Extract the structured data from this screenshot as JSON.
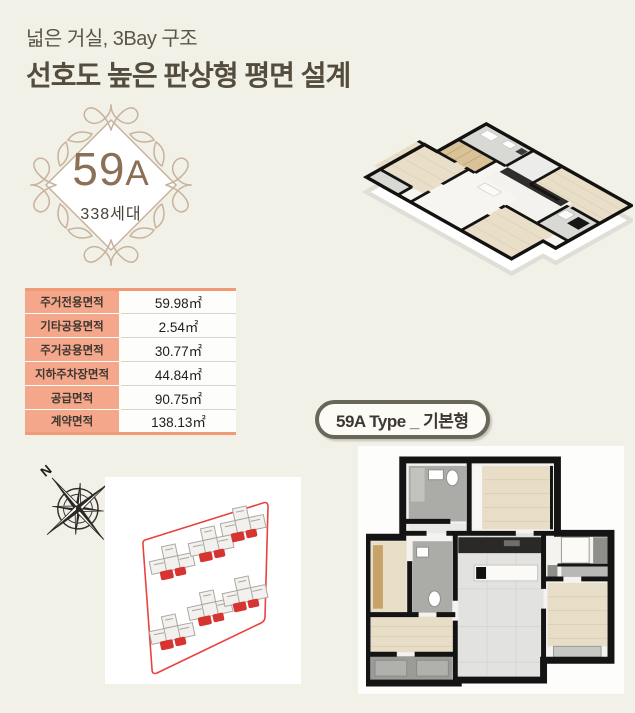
{
  "page_bg": "#f2f1e8",
  "header": {
    "subtitle": "넓은 거실, 3Bay 구조",
    "title": "선호도 높은 판상형 평면 설계"
  },
  "badge": {
    "unit_number": "59",
    "unit_letter": "A",
    "households": "338세대",
    "ornament_color": "#c8b29e",
    "text_color": "#8b7055"
  },
  "area_table": {
    "accent_color": "#f5a78c",
    "rows": [
      {
        "label": "주거전용면적",
        "value": "59.98㎡"
      },
      {
        "label": "기타공용면적",
        "value": "2.54㎡"
      },
      {
        "label": "주거공용면적",
        "value": "30.77㎡"
      },
      {
        "label": "지하주차장면적",
        "value": "44.84㎡"
      },
      {
        "label": "공급면적",
        "value": "90.75㎡"
      },
      {
        "label": "계약면적",
        "value": "138.13㎡"
      }
    ]
  },
  "type_label": {
    "text": "59A Type _ 기본형",
    "border_color": "#6b665a"
  },
  "compass": {
    "label": "N",
    "color": "#33302a"
  },
  "site_plan": {
    "building_count": 6,
    "boundary_color": "#e8433e",
    "unit_highlight_color": "#d63430"
  },
  "floor_plans": {
    "iso_view": "3d-isometric-floor-plan",
    "top_view": "2d-floor-plan"
  }
}
